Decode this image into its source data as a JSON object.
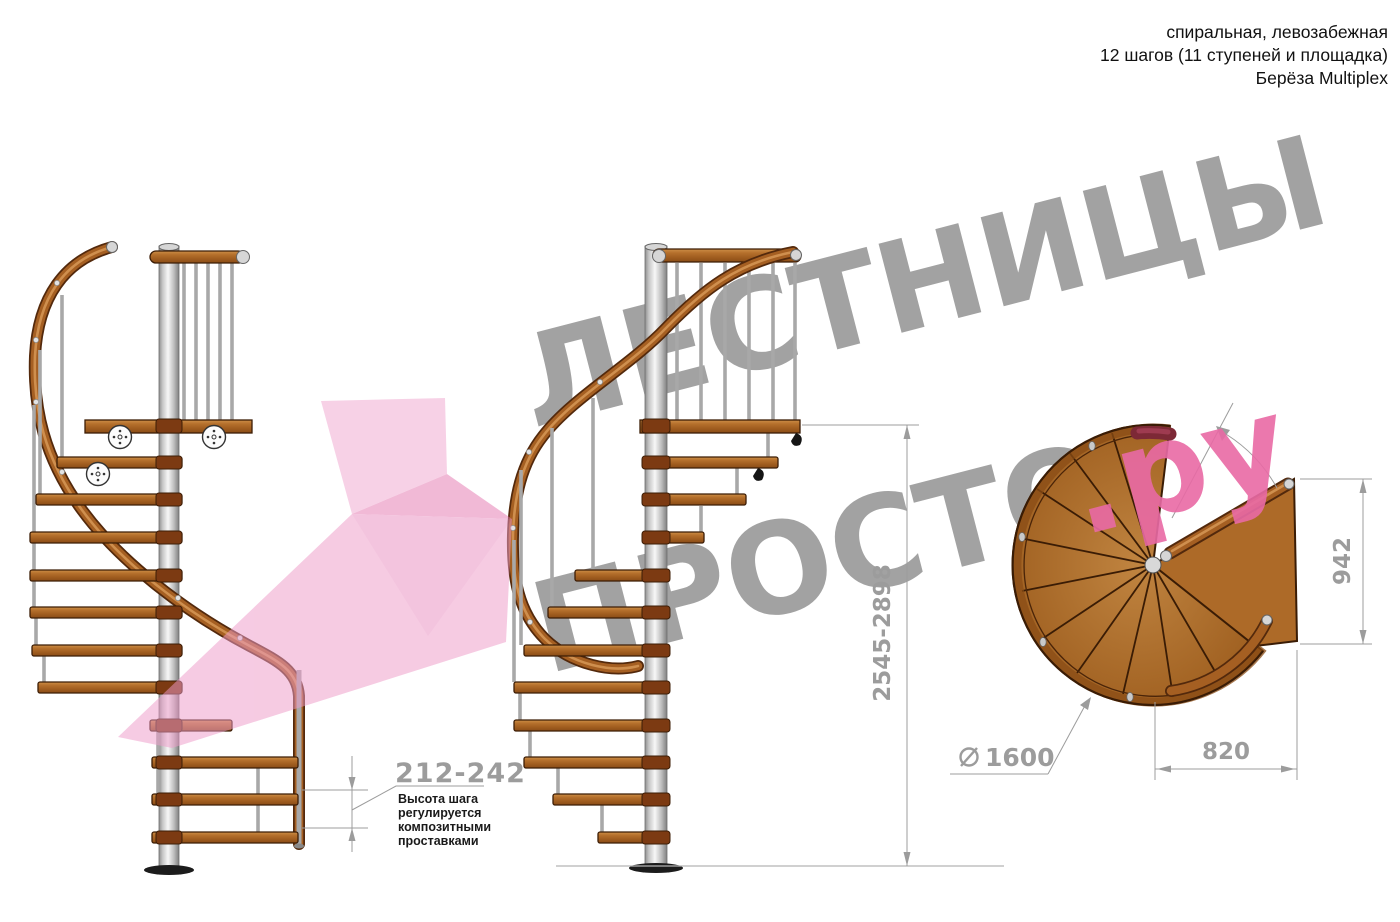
{
  "header": {
    "line1": "спиральная, левозабежная",
    "line2": "12 шагов (11 ступеней и площадка)",
    "line3": "Берёза Multiplex"
  },
  "watermark": {
    "line1": "ЛЕСТНИЦЫ",
    "line2": "ПРОСТО",
    "suffix": ".ру",
    "gray": "#9b9b9b",
    "pink": "#e96aa5"
  },
  "dimensions": {
    "step_height": "212-242",
    "note": {
      "l1": "Высота шага",
      "l2": "регулируется",
      "l3": "композитными",
      "l4": "проставками"
    },
    "total_height": "2545-2898",
    "landing_width": "942",
    "landing_depth": "820",
    "diameter_symbol": "⌀",
    "diameter": "1600"
  },
  "colors": {
    "dimension_gray": "#9c9c9c",
    "watermark_gray": "#9b9b9b",
    "watermark_pink": "#e96aa5",
    "pink_arrow": "#f2b3d7",
    "wood": "#b06c2a",
    "wood_dark": "#3c1d06",
    "metal": "#c9c9c9",
    "maroon_handrail": "#7d2936",
    "text": "#1a1a1a"
  }
}
